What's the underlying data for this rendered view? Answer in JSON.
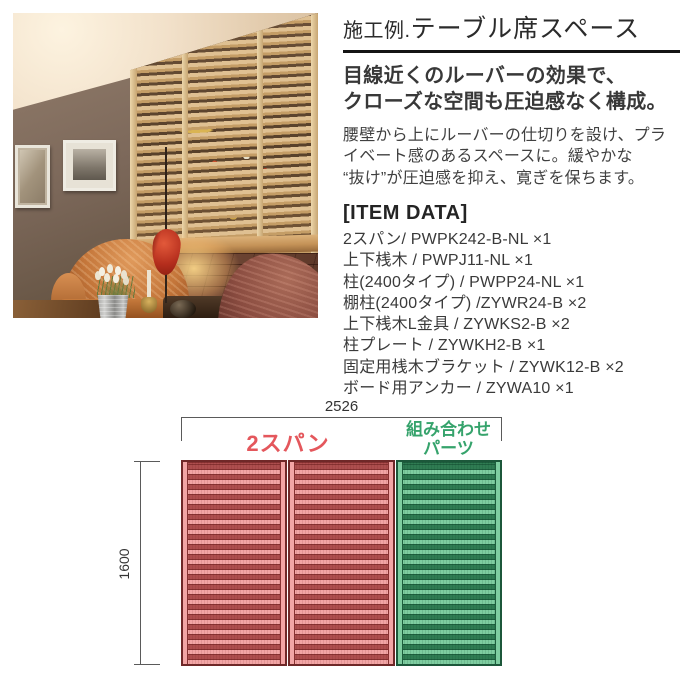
{
  "article": {
    "title_prefix": "施工例.",
    "title_main": "テーブル席スペース",
    "subtitle_lines": [
      "目線近くのルーバーの効果で、",
      "クローズな空間も圧迫感なく構成。"
    ],
    "body_lines": [
      "腰壁から上にルーバーの仕切りを設け、プラ",
      "イベート感のあるスペースに。緩やかな",
      "“抜け”が圧迫感を抑え、寛ぎを保ちます。"
    ],
    "item_data_heading": "[ITEM DATA]",
    "items": [
      "2スパン/ PWPK242-B-NL ×1",
      "上下桟木 / PWPJ11-NL ×1",
      "柱(2400タイプ) / PWPP24-NL ×1",
      "棚柱(2400タイプ) /ZYWR24-B ×2",
      "上下桟木L金具 / ZYWKS2-B ×2",
      "柱プレート / ZYWKH2-B ×1",
      "固定用桟木ブラケット / ZYWK12-B ×2",
      "ボード用アンカー / ZYWA10 ×1"
    ]
  },
  "diagram": {
    "width_label": "2526",
    "height_label": "1600",
    "red_span_label": "2スパン",
    "green_label_lines": [
      "組み合わせ",
      "パーツ"
    ],
    "colors": {
      "accent_red": "#e4575c",
      "accent_green": "#36a36c",
      "panel_red_light": "#f2a5a5",
      "panel_red_dark": "#ad4e4e",
      "panel_red_border": "#6f2828",
      "panel_green_light": "#7ecda0",
      "panel_green_dark": "#2f7b52",
      "panel_green_border": "#1c573a",
      "dimension_line": "#5a5a5a"
    }
  }
}
